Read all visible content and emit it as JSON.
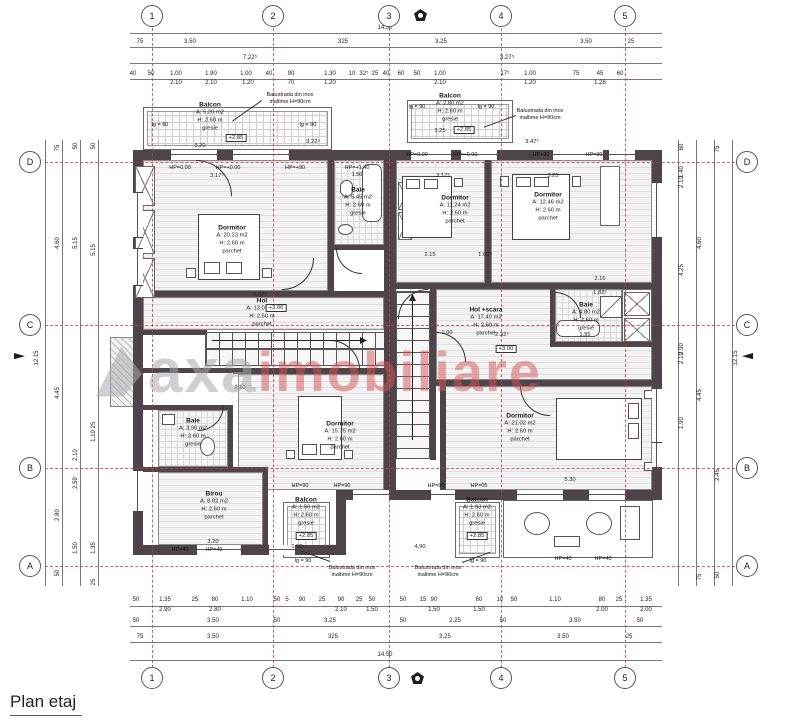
{
  "title": "Plan etaj",
  "watermark": {
    "gray_text": "axa",
    "red_text": "imobiliare",
    "gray_color": "#a9a9b0",
    "red_color": "#d45356"
  },
  "axis_color": "#d03c34",
  "grid": {
    "columns": [
      {
        "label": "1",
        "x": 152
      },
      {
        "label": "2",
        "x": 273
      },
      {
        "label": "3",
        "x": 389
      },
      {
        "label": "4",
        "x": 501
      },
      {
        "label": "5",
        "x": 625
      }
    ],
    "rows": [
      {
        "label": "D",
        "y": 162
      },
      {
        "label": "C",
        "y": 325
      },
      {
        "label": "B",
        "y": 468
      },
      {
        "label": "A",
        "y": 566
      }
    ]
  },
  "rooms": [
    {
      "name": "Dormitor",
      "area": "A: 20.23 m2",
      "height": "H: 2.60 m",
      "finish": "parchet",
      "x": 232,
      "y": 240
    },
    {
      "name": "Baie",
      "area": "A: 5.45 m2",
      "height": "H: 2.60 m",
      "finish": "gresie",
      "x": 358,
      "y": 202
    },
    {
      "name": "Hol",
      "area": "A: 13.03 m2",
      "height": "H: 2.50 m",
      "finish": "parchet",
      "x": 262,
      "y": 313
    },
    {
      "name": "Dormitor",
      "area": "A: 11.24 m2",
      "height": "H: 2.60 m",
      "finish": "parchet",
      "x": 455,
      "y": 210
    },
    {
      "name": "Dormitor",
      "area": "A: 12.46 m2",
      "height": "H: 2.60 m",
      "finish": "parchet",
      "x": 548,
      "y": 207
    },
    {
      "name": "Hol +scara",
      "area": "A: 17.40 m2",
      "height": "H: 2.60 m",
      "finish": "parchet",
      "x": 486,
      "y": 322
    },
    {
      "name": "Baie",
      "area": "A: 4.80 m2",
      "height": "H: 2.60 m",
      "finish": "gresie",
      "x": 586,
      "y": 317
    },
    {
      "name": "Dormitor",
      "area": "A: 15.75 m2",
      "height": "H: 2.60 m",
      "finish": "parchet",
      "x": 340,
      "y": 436
    },
    {
      "name": "Baie",
      "area": "A: 3.90 m2",
      "height": "H: 2.60 m",
      "finish": "gresie",
      "x": 193,
      "y": 433
    },
    {
      "name": "Birou",
      "area": "A: 8.02 m2",
      "height": "H: 2.60 m",
      "finish": "parchet",
      "x": 214,
      "y": 506
    },
    {
      "name": "Dormitor",
      "area": "A: 21.02 m2",
      "height": "H: 2.60 m",
      "finish": "parchet",
      "x": 520,
      "y": 428
    }
  ],
  "balconies": [
    {
      "name": "Balcon",
      "area": "A: 5.20 m2",
      "height": "H: 2.60 m",
      "finish": "gresie",
      "x": 210,
      "y": 117,
      "level": "+2.85",
      "lvx": 236,
      "lvy": 134
    },
    {
      "name": "Balcon",
      "area": "A: 2.80 m2",
      "height": "H: 2.60 m",
      "finish": "gresie",
      "x": 450,
      "y": 108,
      "level": "+2.85",
      "lvx": 464,
      "lvy": 126
    },
    {
      "name": "Balcon",
      "area": "A: 1.50 m2",
      "height": "H: 2.60 m",
      "finish": "gresie",
      "x": 306,
      "y": 512,
      "level": "+2.85",
      "lvx": 306,
      "lvy": 532
    },
    {
      "name": "Balcon",
      "area": "A: 1.93 m2",
      "height": "H: 2.60 m",
      "finish": "gresie",
      "x": 477,
      "y": 512,
      "level": "+2.85",
      "lvx": 477,
      "lvy": 532
    }
  ],
  "lg_labels": [
    {
      "t": "lg = 90",
      "x": 160,
      "y": 122
    },
    {
      "t": "lg = 90",
      "x": 308,
      "y": 122
    },
    {
      "t": "lg = 90",
      "x": 417,
      "y": 104
    },
    {
      "t": "lg = 90",
      "x": 486,
      "y": 104
    },
    {
      "t": "lg = 90",
      "x": 303,
      "y": 558
    },
    {
      "t": "lg = 90",
      "x": 478,
      "y": 558
    }
  ],
  "level_markers": [
    {
      "t": "+3.00",
      "x": 276,
      "y": 304
    },
    {
      "t": "+3.00",
      "x": 506,
      "y": 345
    }
  ],
  "hp_labels": [
    {
      "t": "HP=0.00",
      "x": 180,
      "y": 165
    },
    {
      "t": "HP=+0.00",
      "x": 228,
      "y": 165
    },
    {
      "t": "HP=+90",
      "x": 295,
      "y": 165
    },
    {
      "t": "HP=+1.40",
      "x": 357,
      "y": 165
    },
    {
      "t": "1.50",
      "x": 357,
      "y": 172
    },
    {
      "t": "HP=0.00",
      "x": 417,
      "y": 152
    },
    {
      "t": "HP=+0.00",
      "x": 465,
      "y": 152
    },
    {
      "t": "HP+90",
      "x": 541,
      "y": 152
    },
    {
      "t": "HP=90",
      "x": 594,
      "y": 152
    },
    {
      "t": "HP=90",
      "x": 300,
      "y": 483
    },
    {
      "t": "HP=90",
      "x": 342,
      "y": 483
    },
    {
      "t": "HP=90",
      "x": 436,
      "y": 483
    },
    {
      "t": "HP=05",
      "x": 479,
      "y": 483
    },
    {
      "t": "HP=40",
      "x": 180,
      "y": 547
    },
    {
      "t": "HP=40",
      "x": 214,
      "y": 547
    },
    {
      "t": "HP=40",
      "x": 563,
      "y": 556
    },
    {
      "t": "HP=40",
      "x": 603,
      "y": 556
    }
  ],
  "annotations": [
    {
      "l1": "Balustrada din inox",
      "l2": "inaltime H=90cm",
      "x": 290,
      "y": 92
    },
    {
      "l1": "Balustrada din inox",
      "l2": "inaltime H=90cm",
      "x": 540,
      "y": 108
    },
    {
      "l1": "Balustrada din inox",
      "l2": "inaltime H=90cm",
      "x": 352,
      "y": 565
    },
    {
      "l1": "Balustrada din inox",
      "l2": "inaltime H=90cm",
      "x": 438,
      "y": 565
    }
  ],
  "dims": {
    "h_lines": [
      {
        "y": 33,
        "x1": 130,
        "x2": 662
      },
      {
        "y": 47,
        "x1": 130,
        "x2": 662
      },
      {
        "y": 63,
        "x1": 130,
        "x2": 662
      },
      {
        "y": 79,
        "x1": 130,
        "x2": 662
      },
      {
        "y": 606,
        "x1": 130,
        "x2": 662
      },
      {
        "y": 626,
        "x1": 130,
        "x2": 662
      },
      {
        "y": 642,
        "x1": 130,
        "x2": 662
      },
      {
        "y": 660,
        "x1": 130,
        "x2": 662
      }
    ],
    "v_lines": [
      {
        "x": 45,
        "y1": 140,
        "y2": 586
      },
      {
        "x": 62,
        "y1": 140,
        "y2": 586
      },
      {
        "x": 80,
        "y1": 140,
        "y2": 586
      },
      {
        "x": 98,
        "y1": 140,
        "y2": 586
      },
      {
        "x": 678,
        "y1": 140,
        "y2": 586
      },
      {
        "x": 696,
        "y1": 140,
        "y2": 586
      },
      {
        "x": 714,
        "y1": 140,
        "y2": 586
      },
      {
        "x": 732,
        "y1": 140,
        "y2": 586
      }
    ],
    "rows": [
      {
        "y": 25,
        "labels": [
          {
            "t": "14.50",
            "x": 385
          }
        ]
      },
      {
        "y": 39,
        "labels": [
          {
            "t": "75",
            "x": 140
          },
          {
            "t": "3.50",
            "x": 190
          },
          {
            "t": "325",
            "x": 343
          },
          {
            "t": "3.25",
            "x": 441
          },
          {
            "t": "3.50",
            "x": 586
          },
          {
            "t": "25",
            "x": 631
          }
        ]
      },
      {
        "y": 55,
        "labels": [
          {
            "t": "7.22⁵",
            "x": 250
          },
          {
            "t": "3.27⁵",
            "x": 507
          }
        ]
      },
      {
        "y": 71,
        "labels": [
          {
            "t": "40",
            "x": 133
          },
          {
            "t": "50",
            "x": 151
          },
          {
            "t": "1.00",
            "x": 176
          },
          {
            "t": "1.90",
            "x": 211
          },
          {
            "t": "1.00",
            "x": 246
          },
          {
            "t": "40",
            "x": 269
          },
          {
            "t": "90",
            "x": 291
          },
          {
            "t": "1.30",
            "x": 330
          },
          {
            "t": "10",
            "x": 352
          },
          {
            "t": "32⁵",
            "x": 364
          },
          {
            "t": "25",
            "x": 375
          },
          {
            "t": "40",
            "x": 386
          },
          {
            "t": "60",
            "x": 401
          },
          {
            "t": "50",
            "x": 417
          },
          {
            "t": "1.00",
            "x": 440
          },
          {
            "t": "17⁵",
            "x": 505
          },
          {
            "t": "1.00",
            "x": 530
          },
          {
            "t": "75",
            "x": 576
          },
          {
            "t": "45",
            "x": 600
          },
          {
            "t": "60",
            "x": 620
          }
        ]
      },
      {
        "y": 80,
        "labels": [
          {
            "t": "2.10",
            "x": 176
          },
          {
            "t": "2.10",
            "x": 211
          },
          {
            "t": "1.20",
            "x": 248
          },
          {
            "t": "70",
            "x": 291
          },
          {
            "t": "1.20",
            "x": 330
          },
          {
            "t": "2.10",
            "x": 440
          },
          {
            "t": "1.20",
            "x": 530
          },
          {
            "t": "1.28",
            "x": 600
          }
        ]
      },
      {
        "y": 597,
        "labels": [
          {
            "t": "50",
            "x": 136
          },
          {
            "t": "1.35",
            "x": 165
          },
          {
            "t": "25",
            "x": 195
          },
          {
            "t": "80",
            "x": 215
          },
          {
            "t": "1.10",
            "x": 247
          },
          {
            "t": "50",
            "x": 277
          },
          {
            "t": "5",
            "x": 287
          },
          {
            "t": "90",
            "x": 302
          },
          {
            "t": "25",
            "x": 322
          },
          {
            "t": "90",
            "x": 341
          },
          {
            "t": "25",
            "x": 359
          },
          {
            "t": "50",
            "x": 372
          },
          {
            "t": "50",
            "x": 403
          },
          {
            "t": "15",
            "x": 423
          },
          {
            "t": "90",
            "x": 434
          },
          {
            "t": "60",
            "x": 479
          },
          {
            "t": "10",
            "x": 500
          },
          {
            "t": "50",
            "x": 514
          },
          {
            "t": "1.10",
            "x": 555
          },
          {
            "t": "80",
            "x": 602
          },
          {
            "t": "25",
            "x": 619
          },
          {
            "t": "1.35",
            "x": 646
          }
        ]
      },
      {
        "y": 607,
        "labels": [
          {
            "t": "2.90",
            "x": 165
          },
          {
            "t": "2.80",
            "x": 215
          },
          {
            "t": "2.10",
            "x": 341
          },
          {
            "t": "1.50",
            "x": 372
          },
          {
            "t": "1.50",
            "x": 434
          },
          {
            "t": "1.50",
            "x": 479
          },
          {
            "t": "2.00",
            "x": 602
          },
          {
            "t": "2.00",
            "x": 646
          }
        ]
      },
      {
        "y": 618,
        "labels": [
          {
            "t": "50",
            "x": 136
          },
          {
            "t": "3.50",
            "x": 213
          },
          {
            "t": "50",
            "x": 277
          },
          {
            "t": "3.25",
            "x": 330
          },
          {
            "t": "50",
            "x": 403
          },
          {
            "t": "2.25",
            "x": 455
          },
          {
            "t": "50",
            "x": 503
          },
          {
            "t": "3.50",
            "x": 575
          },
          {
            "t": "50",
            "x": 640
          }
        ]
      },
      {
        "y": 634,
        "labels": [
          {
            "t": "75",
            "x": 140
          },
          {
            "t": "3.50",
            "x": 213
          },
          {
            "t": "325",
            "x": 333
          },
          {
            "t": "3.25",
            "x": 445
          },
          {
            "t": "3.50",
            "x": 563
          },
          {
            "t": "25",
            "x": 629
          }
        ]
      },
      {
        "y": 652,
        "labels": [
          {
            "t": "14.50",
            "x": 385
          }
        ]
      }
    ],
    "cols": [
      {
        "x": 37,
        "labels": [
          {
            "t": "12.15",
            "y": 358
          }
        ]
      },
      {
        "x": 58,
        "labels": [
          {
            "t": "75",
            "y": 148
          },
          {
            "t": "4.60",
            "y": 243
          },
          {
            "t": "4.45",
            "y": 393
          },
          {
            "t": "2.80",
            "y": 515
          },
          {
            "t": "50",
            "y": 573
          }
        ]
      },
      {
        "x": 76,
        "labels": [
          {
            "t": "50",
            "y": 146
          },
          {
            "t": "5.15",
            "y": 243
          },
          {
            "t": "2.10",
            "y": 455
          },
          {
            "t": "2.59",
            "y": 483
          },
          {
            "t": "1.50",
            "y": 548
          }
        ]
      },
      {
        "x": 94,
        "labels": [
          {
            "t": "50",
            "y": 146
          },
          {
            "t": "5.15",
            "y": 250
          },
          {
            "t": "25",
            "y": 425
          },
          {
            "t": "1.10",
            "y": 436
          },
          {
            "t": "1.35",
            "y": 548
          },
          {
            "t": "25",
            "y": 582
          }
        ]
      },
      {
        "x": 682,
        "labels": [
          {
            "t": "60",
            "y": 147
          },
          {
            "t": "1.40",
            "y": 172
          },
          {
            "t": "2.10",
            "y": 182
          },
          {
            "t": "4.25",
            "y": 270
          },
          {
            "t": "2.90",
            "y": 349
          },
          {
            "t": "2.10",
            "y": 358
          },
          {
            "t": "1.90",
            "y": 423
          }
        ]
      },
      {
        "x": 700,
        "labels": [
          {
            "t": "4.60",
            "y": 243
          },
          {
            "t": "4.45",
            "y": 395
          },
          {
            "t": "75",
            "y": 577
          }
        ]
      },
      {
        "x": 718,
        "labels": [
          {
            "t": "75",
            "y": 149
          },
          {
            "t": "2.45",
            "y": 475
          },
          {
            "t": "50",
            "y": 575
          }
        ]
      },
      {
        "x": 736,
        "labels": [
          {
            "t": "12.15",
            "y": 358
          }
        ]
      }
    ],
    "interior": [
      {
        "t": "3.17⁵",
        "x": 217,
        "y": 173
      },
      {
        "t": "3.22⁵",
        "x": 313,
        "y": 139
      },
      {
        "t": "3.47⁵",
        "x": 532,
        "y": 139
      },
      {
        "t": "3.17⁵",
        "x": 443,
        "y": 173
      },
      {
        "t": "3.25",
        "x": 553,
        "y": 173
      },
      {
        "t": "2.15",
        "x": 430,
        "y": 252
      },
      {
        "t": "1.02⁵",
        "x": 485,
        "y": 252
      },
      {
        "t": "2.16",
        "x": 600,
        "y": 276
      },
      {
        "t": "6.07⁵",
        "x": 260,
        "y": 292
      },
      {
        "t": "1.00",
        "x": 447,
        "y": 330
      },
      {
        "t": "2.32⁵",
        "x": 502,
        "y": 332
      },
      {
        "t": "1.95",
        "x": 585,
        "y": 332
      },
      {
        "t": "2.10",
        "x": 240,
        "y": 385
      },
      {
        "t": "1.82⁵",
        "x": 600,
        "y": 290
      },
      {
        "t": "3.20",
        "x": 213,
        "y": 539
      },
      {
        "t": "1.50",
        "x": 297,
        "y": 544
      },
      {
        "t": "4.90",
        "x": 420,
        "y": 544
      },
      {
        "t": "5.30",
        "x": 570,
        "y": 477
      },
      {
        "t": "3.20",
        "x": 200,
        "y": 143
      },
      {
        "t": "3.25",
        "x": 440,
        "y": 128
      }
    ]
  }
}
